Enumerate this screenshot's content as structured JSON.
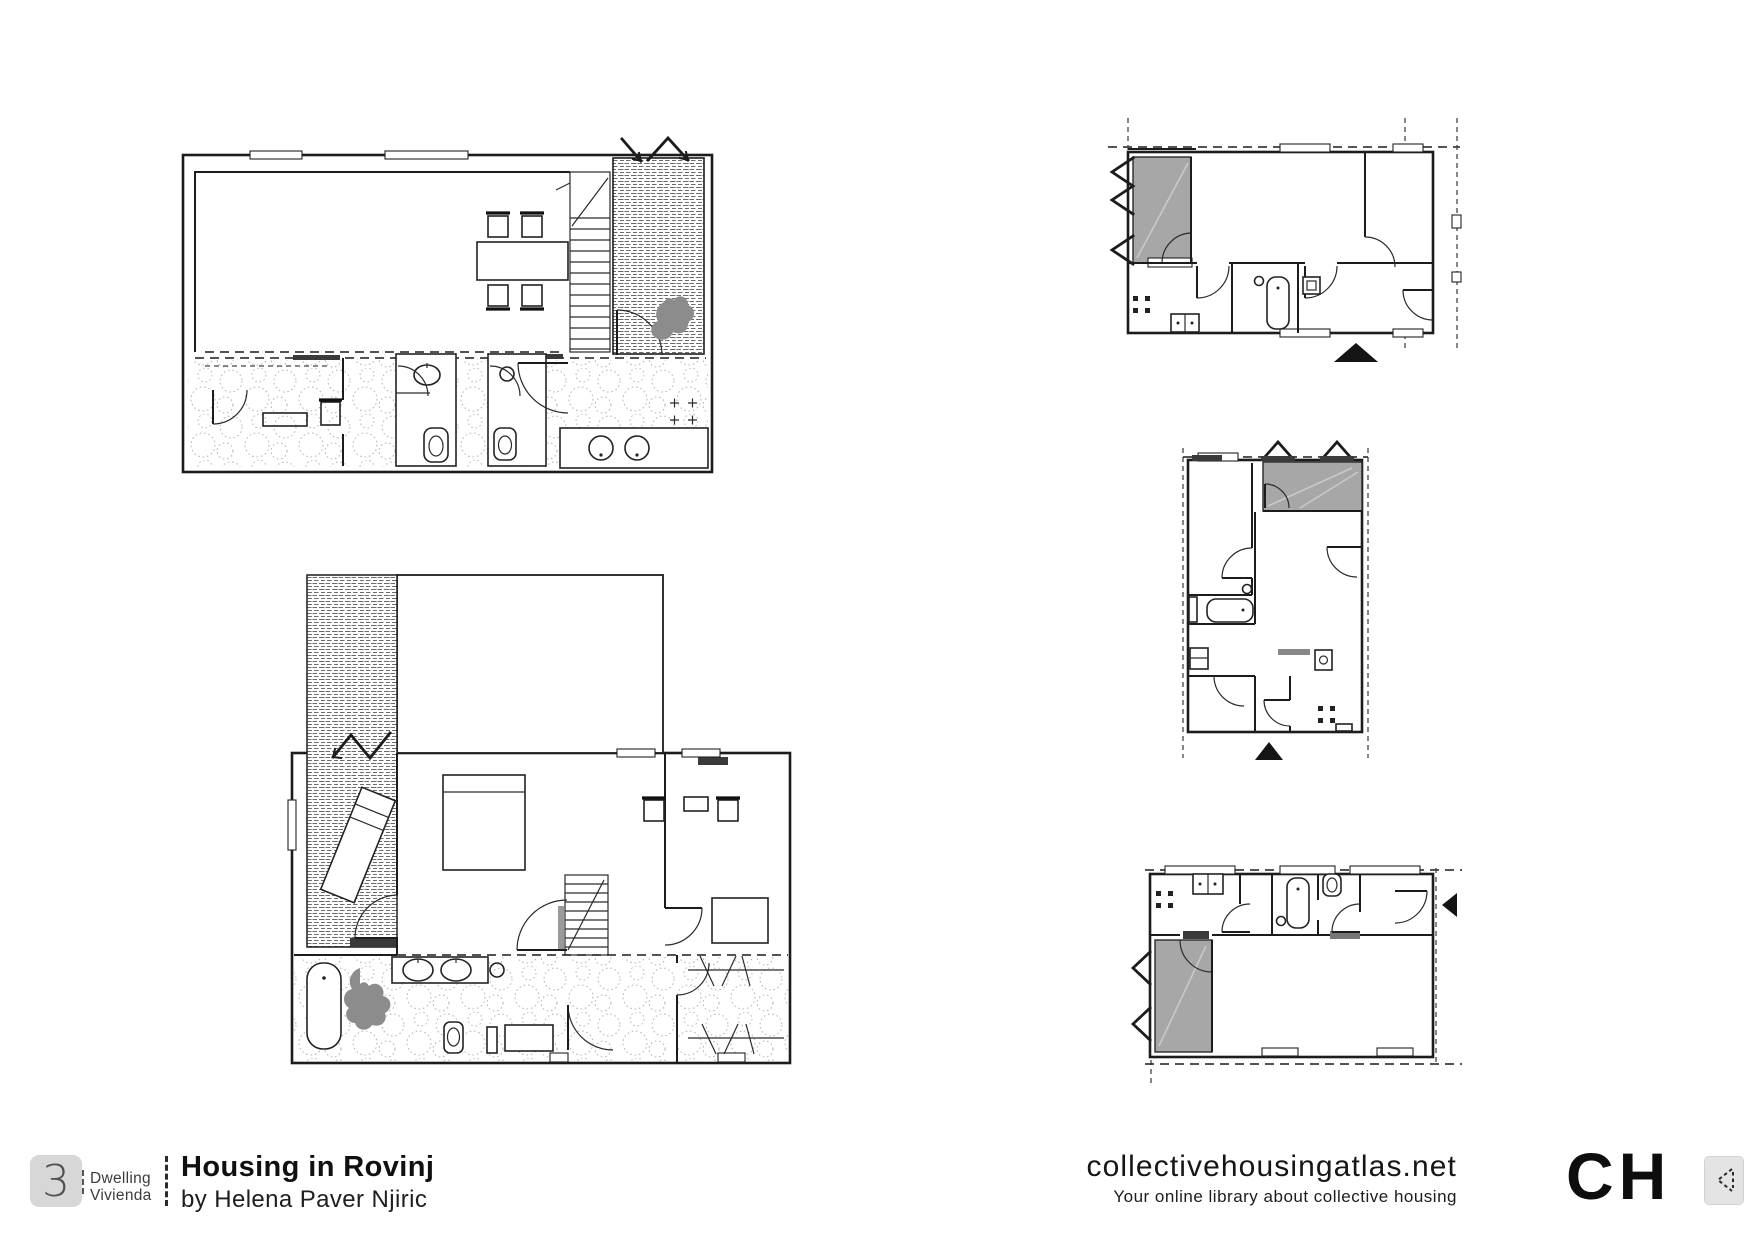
{
  "page": {
    "width": 1754,
    "height": 1240,
    "background": "#ffffff"
  },
  "footer": {
    "project": {
      "dwellings_count": "3",
      "count_label_en": "Dwelling",
      "count_label_es": "Vivienda",
      "title": "Housing in Rovinj",
      "byline": "by Helena Paver Njiric"
    },
    "brand": {
      "site": "collectivehousingatlas.net",
      "tagline": "Your online library about collective housing",
      "logo_text": "CH",
      "arrow_icon": "dashed-left-chevron-icon"
    }
  },
  "drawing": {
    "colors": {
      "line": "#1c1c1c",
      "area_gray": "#a7a7a7",
      "plant_gray": "#8c8c8c",
      "dark_band": "#3a3a3a",
      "marker_black": "#141414",
      "logo_square_gray": "#d7d7d7",
      "arrow_box_gray": "#e4e4e4"
    },
    "symbols": [
      "entrance-zigzag-arrow",
      "entry-direction-triangle",
      "louver-sawtooth",
      "door-swing-arc",
      "stair-treads",
      "deck-hatch",
      "stone-paving-dots"
    ]
  }
}
